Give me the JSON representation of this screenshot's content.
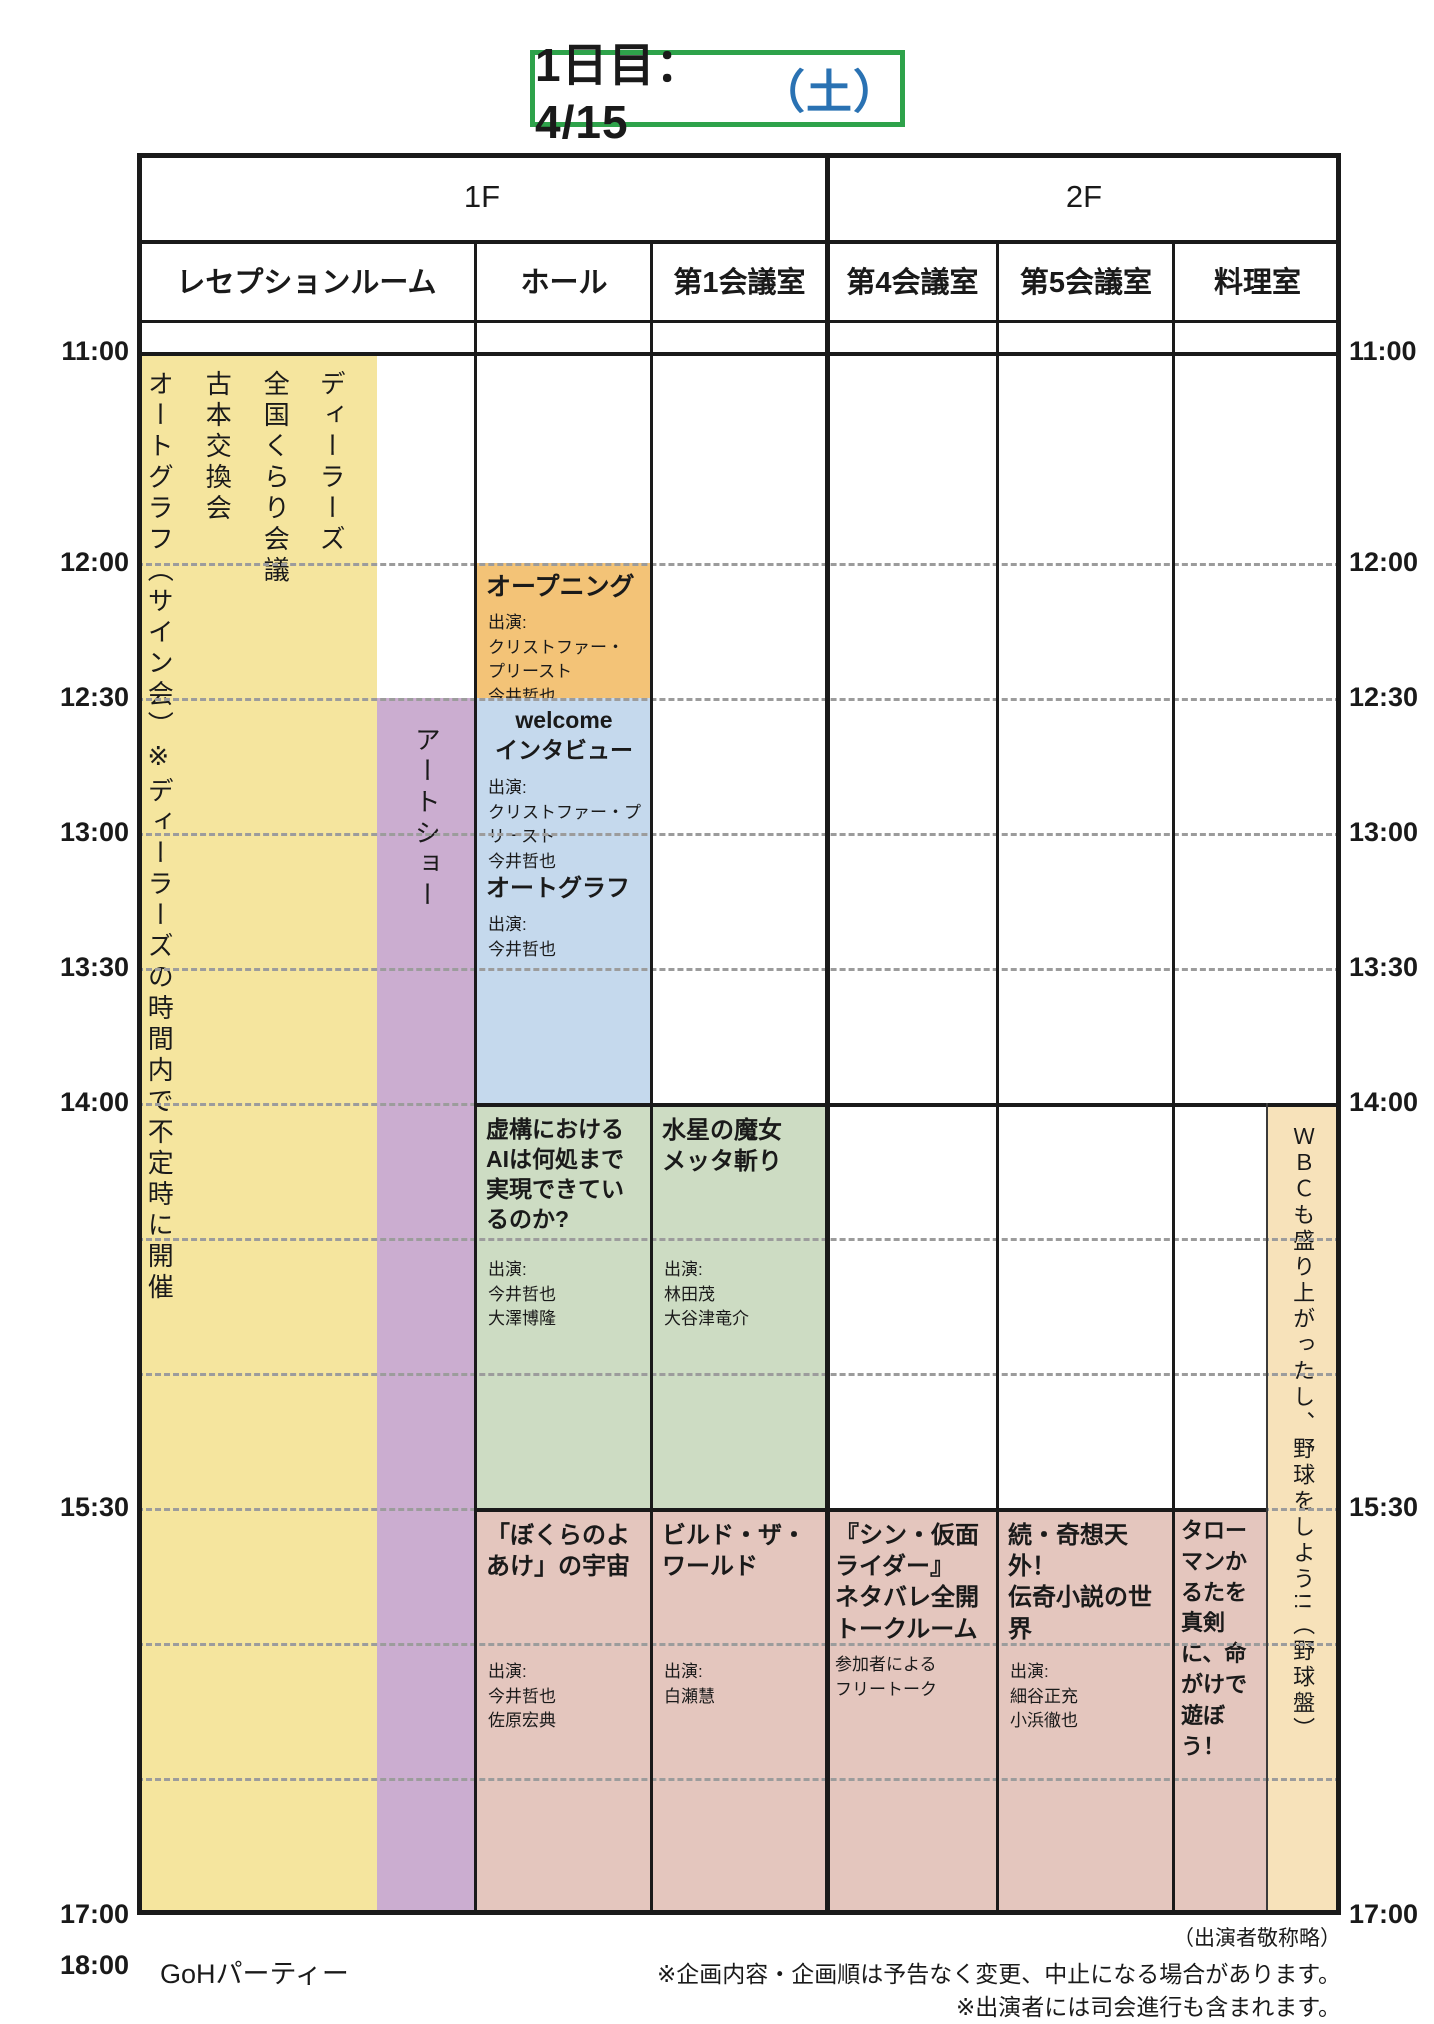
{
  "title": {
    "date": "1日目：4/15",
    "weekday": "（土）"
  },
  "floors": {
    "f1": "1F",
    "f2": "2F"
  },
  "rooms": {
    "reception": "レセプションルーム",
    "hall": "ホール",
    "room1": "第1会議室",
    "room4": "第4会議室",
    "room5": "第5会議室",
    "cooking": "料理室"
  },
  "times": {
    "t1100": "11:00",
    "t1200": "12:00",
    "t1230": "12:30",
    "t1300": "13:00",
    "t1330": "13:30",
    "t1400": "14:00",
    "t1530": "15:30",
    "t1700": "17:00",
    "t1800": "18:00"
  },
  "events": {
    "dealers": "ディーラーズ",
    "kurari_meeting": "全国くらり会議",
    "book_exchange": "古本交換会",
    "autograph_signing": "オートグラフ（サイン会）※ディーラーズの時間内で不定時に開催",
    "art_show": "アートショー",
    "opening": {
      "title": "オープニング",
      "cast": "出演:\nクリストファー・\nプリースト\n今井哲也"
    },
    "welcome_interview": {
      "title": "welcome\nインタビュー",
      "cast": "出演:\nクリストファー・プ\nリースト\n今井哲也"
    },
    "autograph_hall": {
      "title": "オートグラフ",
      "cast": "出演:\n今井哲也"
    },
    "fiction_ai": {
      "title": "虚構におけるAIは何処まで実現できているのか?",
      "cast": "出演:\n今井哲也\n大澤博隆"
    },
    "suisei_majo": {
      "title": "水星の魔女\nメッタ斬り",
      "cast": "出演:\n林田茂\n大谷津竜介"
    },
    "bokura_no_yoake": {
      "title": "「ぼくらのよあけ」の宇宙",
      "cast": "出演:\n今井哲也\n佐原宏典"
    },
    "build_the_world": {
      "title": "ビルド・ザ・ワールド",
      "cast": "出演:\n白瀬慧"
    },
    "shin_kamen_rider": {
      "title": "『シン・仮面ライダー』\nネタバレ全開\nトークルーム",
      "cast": "参加者による\nフリートーク"
    },
    "kiso_tengai": {
      "title": "続・奇想天外！\n伝奇小説の世界",
      "cast": "出演:\n細谷正充\n小浜徹也"
    },
    "taroman_karuta": "タローマンかるたを真剣に、命がけで遊ぼう！",
    "wbc_baseball": "ＷＢＣも盛り上がったし、野球をしよう!!（野球盤）"
  },
  "footer": {
    "goh_party": "GoHパーティー",
    "honorifics_note": "（出演者敬称略）",
    "note1": "※企画内容・企画順は予告なく変更、中止になる場合があります。",
    "note2": "※出演者には司会進行も含まれます。"
  }
}
